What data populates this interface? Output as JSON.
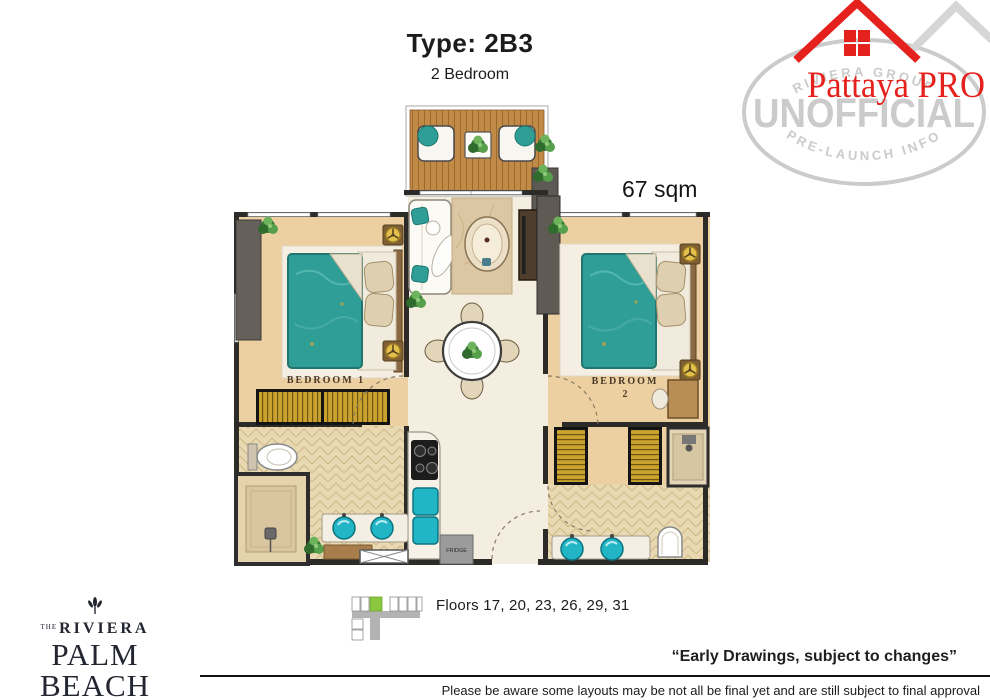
{
  "header": {
    "unit_type": "Type: 2B3",
    "unit_subtitle": "2 Bedroom",
    "area": "67 sqm"
  },
  "watermark": {
    "brand": "Pattaya PRO",
    "stamp_top": "RIVIERA GROUP",
    "stamp_center": "UNOFFICIAL",
    "stamp_bottom": "PRE-LAUNCH INFO"
  },
  "colors": {
    "brand_red": "#e5211d",
    "stamp_gray": "#cbcbcb",
    "accent_teal": "#2f9e96",
    "highlight_green": "#8dc63f"
  },
  "floorplan": {
    "bedroom1_label": "BEDROOM 1",
    "bedroom2_label": "BEDROOM",
    "bedroom2_number": "2",
    "fridge_label": "FRIDGE"
  },
  "keyplan": {
    "floors": "Floors 17, 20, 23, 26, 29, 31"
  },
  "developer": {
    "the": "THE",
    "name": "RIVIERA",
    "project": "PALM BEACH",
    "location": "WONGAMAT"
  },
  "footer": {
    "quote": "“Early Drawings, subject to changes”",
    "disclaimer": "Please be aware some layouts may be not all be final yet and are still subject to final approval"
  }
}
